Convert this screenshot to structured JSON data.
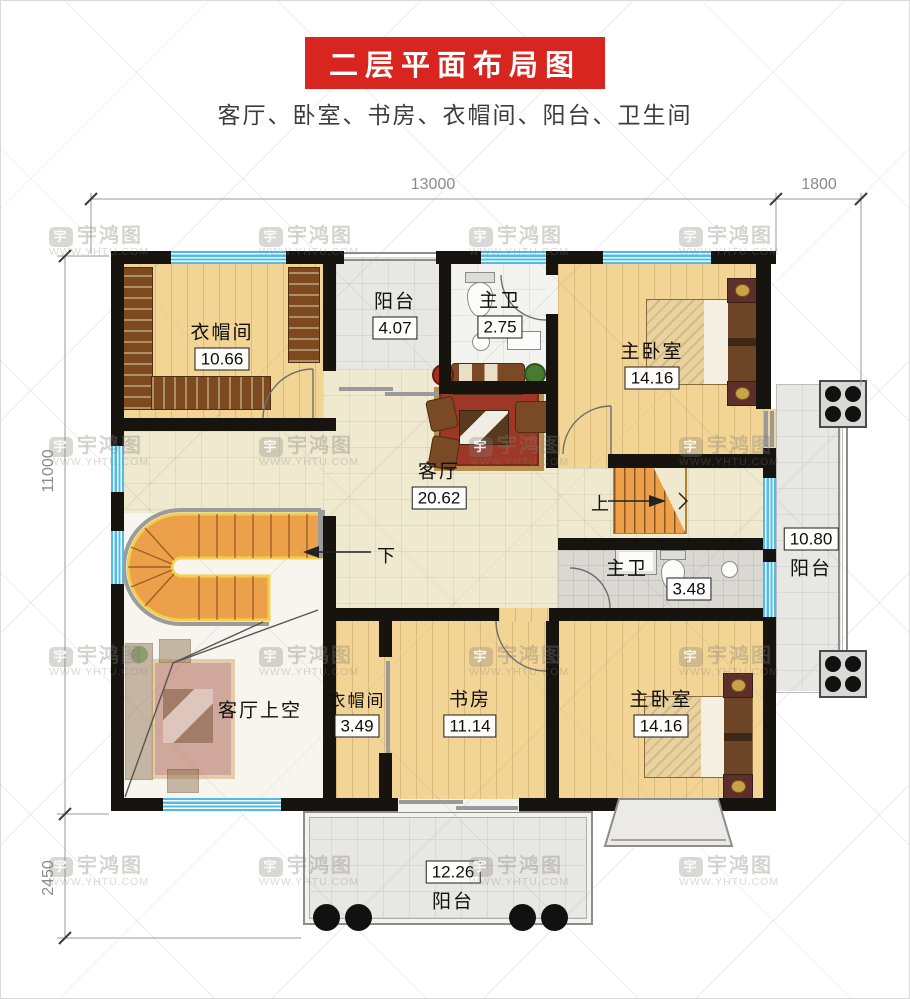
{
  "header": {
    "title": "二层平面布局图",
    "subtitle": "客厅、卧室、书房、衣帽间、阳台、卫生间"
  },
  "dimensions": {
    "top_main": "13000",
    "top_right": "1800",
    "left_main": "11000",
    "left_bottom": "2450"
  },
  "watermark": {
    "brand": "宇鸿图",
    "site": "WWW.YHTU.COM",
    "logo_glyph": "宇"
  },
  "rooms": {
    "cloak_top": {
      "name": "衣帽间",
      "area": "10.66"
    },
    "balcony_top": {
      "name": "阳台",
      "area": "4.07"
    },
    "bath_top": {
      "name": "主卫",
      "area": "2.75"
    },
    "master_top": {
      "name": "主卧室",
      "area": "14.16"
    },
    "living": {
      "name": "客厅",
      "area": "20.62"
    },
    "bath_mid": {
      "name": "主卫",
      "area": "3.48"
    },
    "balcony_right": {
      "name": "阳台",
      "area": "10.80"
    },
    "living_void": {
      "name": "客厅上空"
    },
    "cloak_bottom": {
      "name": "衣帽间",
      "area": "3.49"
    },
    "study": {
      "name": "书房",
      "area": "11.14"
    },
    "master_bottom": {
      "name": "主卧室",
      "area": "14.16"
    },
    "balcony_bottom": {
      "name": "阳台",
      "area": "12.26"
    }
  },
  "stairs": {
    "up": "上",
    "down": "下"
  },
  "colors": {
    "accent_red": "#d9251f",
    "wall_black": "#17140f",
    "window_blue": "#4fbce8",
    "stair_orange": "#eca04a",
    "wood_floor": "#f2d494"
  }
}
